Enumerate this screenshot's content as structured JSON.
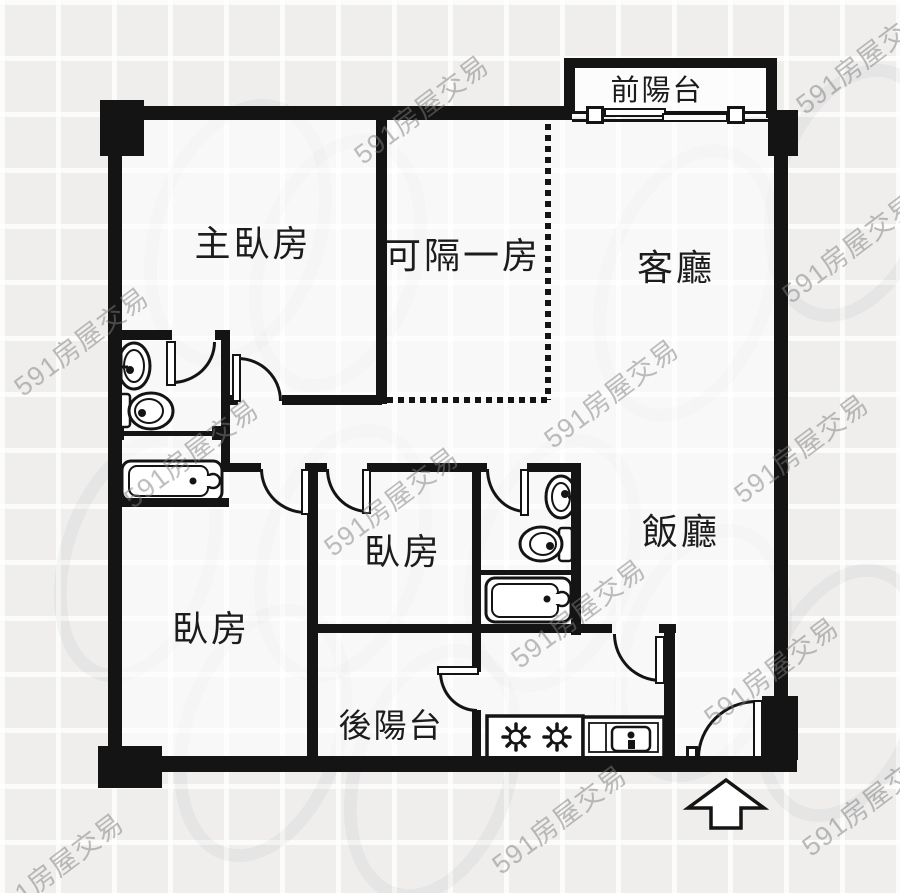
{
  "watermark_text": "591房屋交易",
  "rooms": {
    "front_balcony": "前陽台",
    "master_bedroom": "主臥房",
    "partitionable_room": "可隔一房",
    "living_room": "客廳",
    "bedroom_middle": "臥房",
    "dining_room": "飯廳",
    "bedroom_left": "臥房",
    "rear_balcony": "後陽台"
  },
  "colors": {
    "wall": "#141414",
    "background": "#efeeed",
    "interior": "#ffffff",
    "watermark": "#7d7d7d"
  },
  "fixtures": [
    "pedestal-sink",
    "toilet",
    "shower-rod",
    "bathtub",
    "gas-stove",
    "kitchen-sink-counter",
    "sliding-door",
    "entrance-arrow"
  ]
}
